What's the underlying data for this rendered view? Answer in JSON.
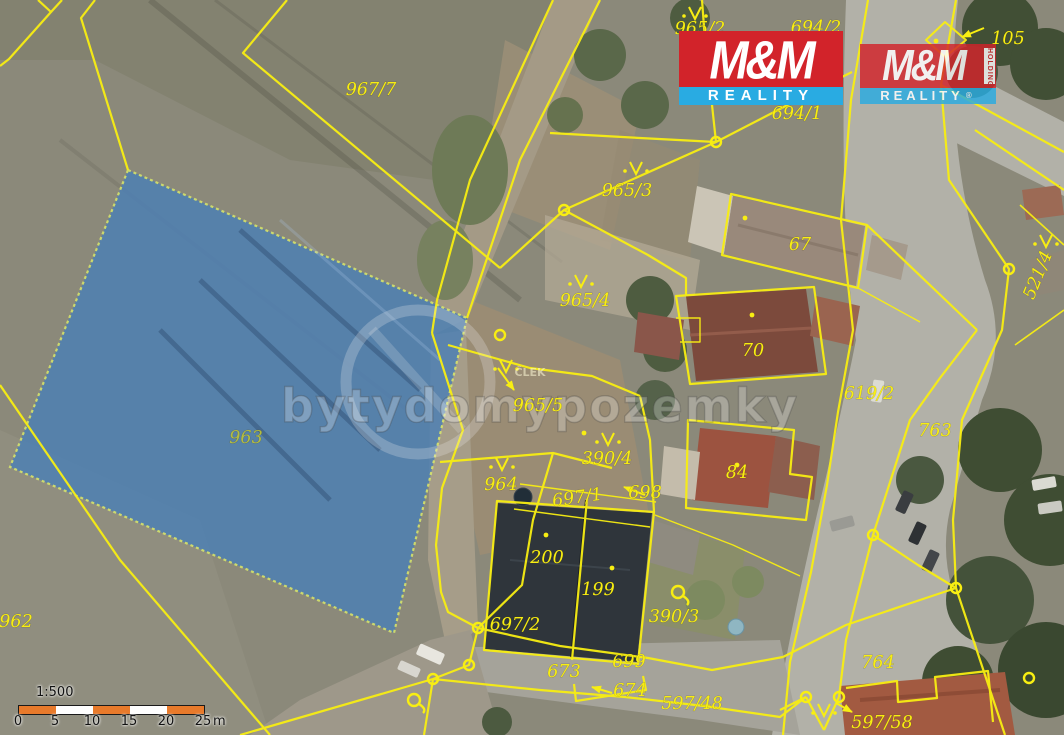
{
  "map": {
    "name": "cadastral-aerial-map",
    "highlighted_parcel": "963",
    "colors": {
      "highlight_fill": "#4d80b4",
      "highlight_border": "#d9e96b",
      "boundary_yellow": "#f8ee12",
      "scale_orange": "#e87a2b",
      "field": "#8b897a",
      "road": "#b2b1a8"
    },
    "parcel_labels": [
      {
        "text": "967/7",
        "x": 371,
        "y": 95
      },
      {
        "text": "965/2",
        "x": 700,
        "y": 34
      },
      {
        "text": "694/2",
        "x": 816,
        "y": 33
      },
      {
        "text": "694/1",
        "x": 797,
        "y": 119
      },
      {
        "text": "105",
        "x": 1008,
        "y": 44
      },
      {
        "text": "965/3",
        "x": 627,
        "y": 196
      },
      {
        "text": "67",
        "x": 800,
        "y": 250
      },
      {
        "text": "965/4",
        "x": 585,
        "y": 306
      },
      {
        "text": "70",
        "x": 753,
        "y": 356
      },
      {
        "text": "965/5",
        "x": 538,
        "y": 411
      },
      {
        "text": "390/4",
        "x": 607,
        "y": 464
      },
      {
        "text": "964",
        "x": 501,
        "y": 490
      },
      {
        "text": "697/1",
        "x": 578,
        "y": 503,
        "rot": -8
      },
      {
        "text": "698",
        "x": 645,
        "y": 498
      },
      {
        "text": "84",
        "x": 737,
        "y": 478
      },
      {
        "text": "619/2",
        "x": 869,
        "y": 399
      },
      {
        "text": "763",
        "x": 935,
        "y": 436
      },
      {
        "text": "521/4",
        "x": 1043,
        "y": 277,
        "rot": -68
      },
      {
        "text": "963",
        "x": 246,
        "y": 443,
        "color": "#b4bd41"
      },
      {
        "text": "962",
        "x": 16,
        "y": 627
      },
      {
        "text": "200",
        "x": 547,
        "y": 563
      },
      {
        "text": "199",
        "x": 598,
        "y": 595
      },
      {
        "text": "390/3",
        "x": 674,
        "y": 622
      },
      {
        "text": "697/2",
        "x": 515,
        "y": 630
      },
      {
        "text": "673",
        "x": 564,
        "y": 677
      },
      {
        "text": "699",
        "x": 629,
        "y": 667
      },
      {
        "text": "674",
        "x": 630,
        "y": 696
      },
      {
        "text": "597/48",
        "x": 692,
        "y": 709
      },
      {
        "text": "597/58",
        "x": 882,
        "y": 728
      },
      {
        "text": "764",
        "x": 878,
        "y": 668
      }
    ],
    "symbols": [
      {
        "type": "orchard",
        "x": 695,
        "y": 15
      },
      {
        "type": "orchard",
        "x": 636,
        "y": 170
      },
      {
        "type": "orchard",
        "x": 581,
        "y": 283
      },
      {
        "type": "orchard",
        "x": 506,
        "y": 368
      },
      {
        "type": "orchard",
        "x": 608,
        "y": 441
      },
      {
        "type": "orchard",
        "x": 502,
        "y": 466
      },
      {
        "type": "orchard",
        "x": 1046,
        "y": 243
      },
      {
        "type": "orchard",
        "x": 824,
        "y": 712
      },
      {
        "type": "well",
        "x": 678,
        "y": 592
      },
      {
        "type": "well",
        "x": 414,
        "y": 700
      }
    ]
  },
  "watermark": {
    "text": "bytydomypozemky",
    "badge": "ČLEK"
  },
  "logos": {
    "primary": {
      "title": "M&M",
      "subtitle": "REALITY"
    },
    "secondary": {
      "title": "M&M",
      "subtitle": "REALITY",
      "vertical": "HOLDING",
      "registered": "®"
    }
  },
  "scale": {
    "ratio": "1:500",
    "ticks": [
      "0",
      "5",
      "10",
      "15",
      "20",
      "25"
    ],
    "unit": "m"
  }
}
